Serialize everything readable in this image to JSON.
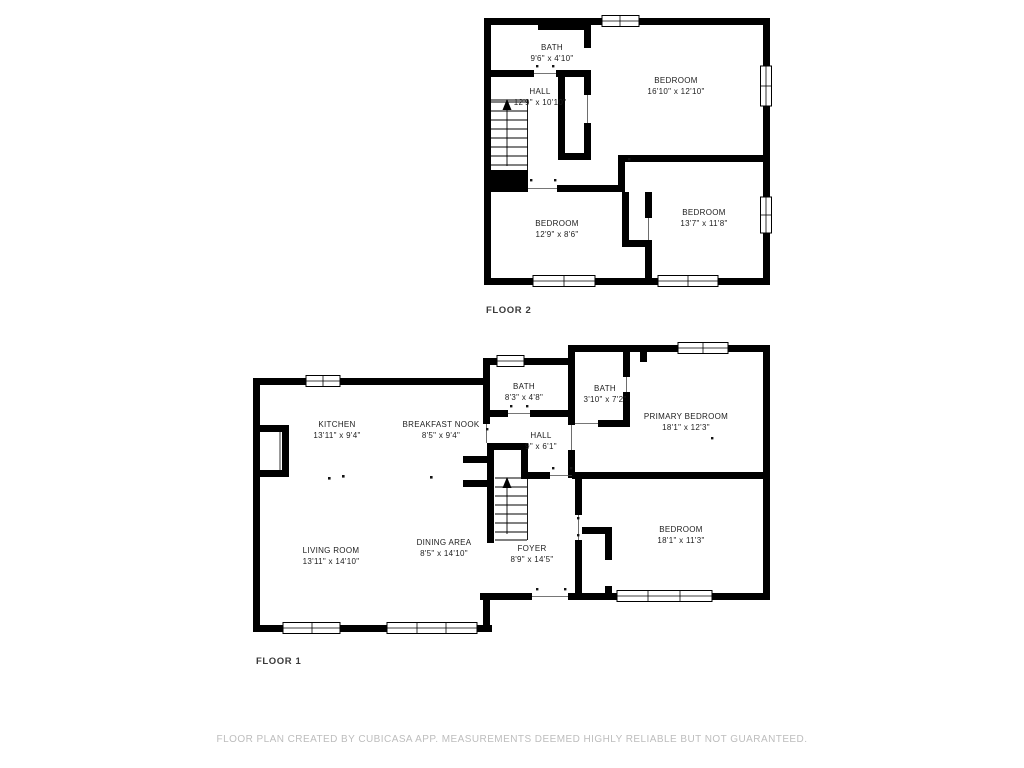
{
  "floor2": {
    "label": "FLOOR 2",
    "rooms": {
      "bath": {
        "name": "BATH",
        "dims": "9'6\" x 4'10\""
      },
      "hall": {
        "name": "HALL",
        "dims": "12'9\" x 10'10\""
      },
      "bedroom_large": {
        "name": "BEDROOM",
        "dims": "16'10\" x 12'10\""
      },
      "bedroom_left": {
        "name": "BEDROOM",
        "dims": "12'9\" x 8'6\""
      },
      "bedroom_right": {
        "name": "BEDROOM",
        "dims": "13'7\" x 11'8\""
      }
    }
  },
  "floor1": {
    "label": "FLOOR 1",
    "rooms": {
      "kitchen": {
        "name": "KITCHEN",
        "dims": "13'11\" x 9'4\""
      },
      "breakfast_nook": {
        "name": "BREAKFAST NOOK",
        "dims": "8'5\" x 9'4\""
      },
      "bath": {
        "name": "BATH",
        "dims": "8'3\" x 4'8\""
      },
      "bath_small": {
        "name": "BATH",
        "dims": "3'10\" x 7'2\""
      },
      "primary_bedroom": {
        "name": "PRIMARY BEDROOM",
        "dims": "18'1\" x 12'3\""
      },
      "hall": {
        "name": "HALL",
        "dims": "9\" x 6'1\""
      },
      "living_room": {
        "name": "LIVING ROOM",
        "dims": "13'11\" x 14'10\""
      },
      "dining_area": {
        "name": "DINING AREA",
        "dims": "8'5\" x 14'10\""
      },
      "foyer": {
        "name": "FOYER",
        "dims": "8'9\" x 14'5\""
      },
      "bedroom": {
        "name": "BEDROOM",
        "dims": "18'1\" x 11'3\""
      }
    }
  },
  "footer": "FLOOR PLAN CREATED BY CUBICASA APP. MEASUREMENTS DEEMED HIGHLY RELIABLE BUT NOT GUARANTEED.",
  "colors": {
    "wall": "#000000",
    "room_text": "#1d1d1d",
    "floor_label_text": "#3a3a3a",
    "footer_text": "#bdbdbd",
    "background": "#ffffff"
  }
}
